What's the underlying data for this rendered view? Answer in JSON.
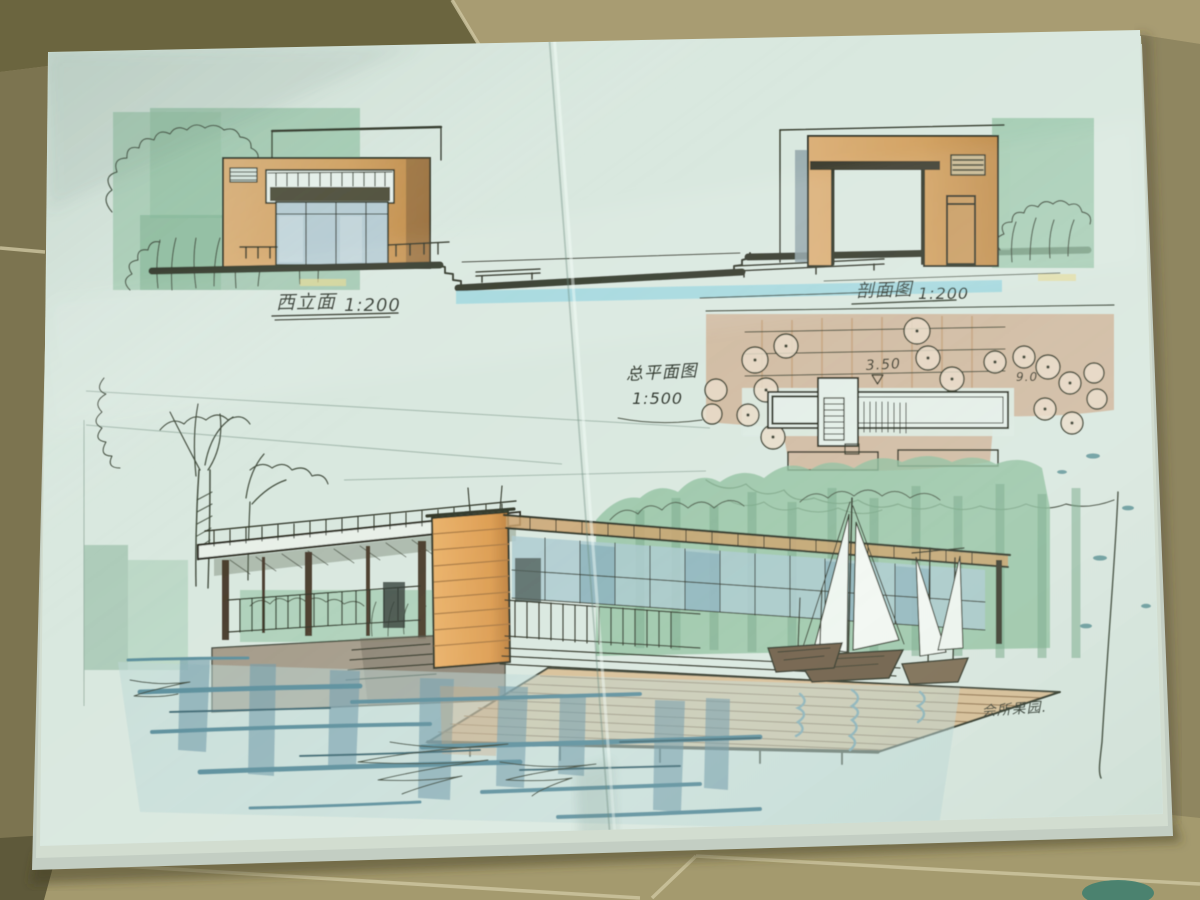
{
  "labels": {
    "west_elevation": "西立面",
    "west_elevation_scale": "1:200",
    "section": "剖面图",
    "section_scale": "1:200",
    "site_plan": "总平面图",
    "site_plan_scale": "1:500",
    "spot_main": "3.50",
    "spot_right": "9.0",
    "signature": "会所果园."
  },
  "colors": {
    "paper": "#d9e8df",
    "floor_tile_light": "#a89c72",
    "floor_tile_dark": "#6b653f",
    "grout": "#cfc7a2",
    "ink": "#2f3526",
    "marker_green_light": "#a3cbb0",
    "marker_green": "#8fbf9e",
    "marker_green_dark": "#76a888",
    "marker_tan_wall": "#d5a568",
    "marker_tan_wash": "#cdab8a",
    "marker_orange_tower": "#e2a55c",
    "water_teal": "#6f9aa8",
    "water_cyan_strip": "#a4d8de",
    "glass_blue": "#a9c9ce",
    "deck_wood": "#d7bb90"
  }
}
